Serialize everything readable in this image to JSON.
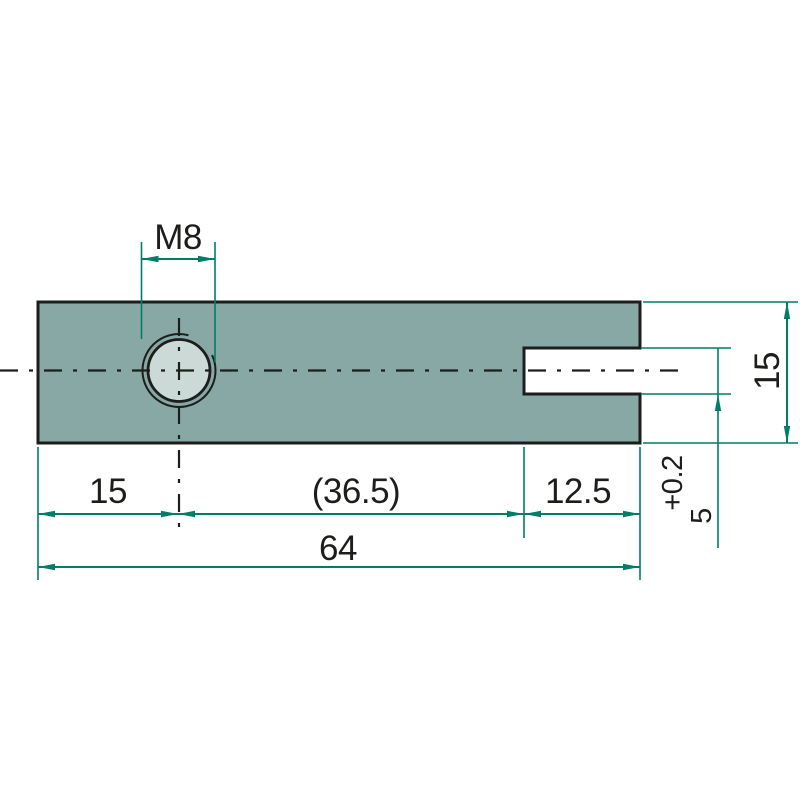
{
  "labels": {
    "thread": "M8",
    "hole_offset": "15",
    "hole_to_slot": "(36.5)",
    "slot_depth": "12.5",
    "overall_length": "64",
    "bar_height": "15",
    "slot_height": "5",
    "slot_height_tolerance": "+0.2"
  },
  "colors": {
    "background": "#ffffff",
    "part_fill": "#87A8A4",
    "hole_fill": "#CBDAD6",
    "outline": "#1D1D1B",
    "dimension_green": "#007D68",
    "text": "#1D1D1B"
  }
}
